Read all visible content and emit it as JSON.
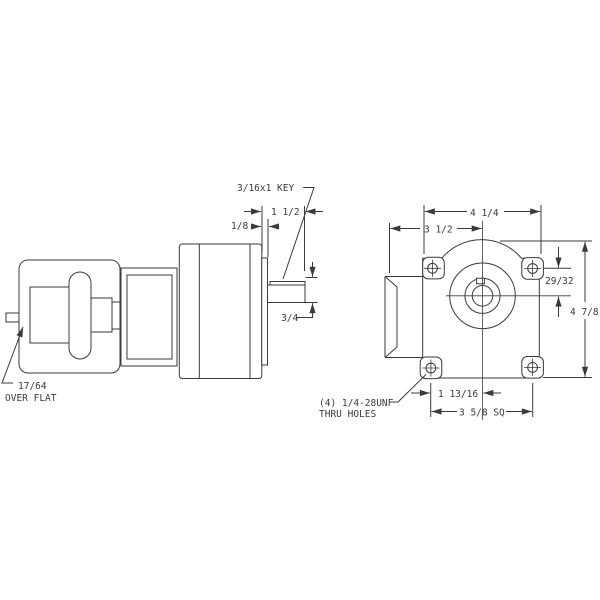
{
  "drawing": {
    "title": "gearmotor-dimension-drawing",
    "views": {
      "side_view": "motor-gearbox-side-view",
      "end_view": "gearbox-face-end-view"
    },
    "annotations": {
      "key_label": "3/16x1 KEY",
      "shaft_length": "1 1/2",
      "boss_width": "1/8",
      "shaft_diameter": "3/4",
      "rear_shaft_line1": "17/64",
      "rear_shaft_line2": "OVER FLAT",
      "overall_width": "4 1/4",
      "face_to_center": "3 1/2",
      "center_offset": "29/32",
      "overall_height": "4 7/8",
      "hole_to_center": "1 13/16",
      "bolt_square": "3 5/8 SQ",
      "thru_holes_line1": "(4) 1/4-28UNF",
      "thru_holes_line2": "THRU HOLES"
    },
    "colors": {
      "line": "#3a3a3a",
      "background": "#ffffff"
    }
  }
}
